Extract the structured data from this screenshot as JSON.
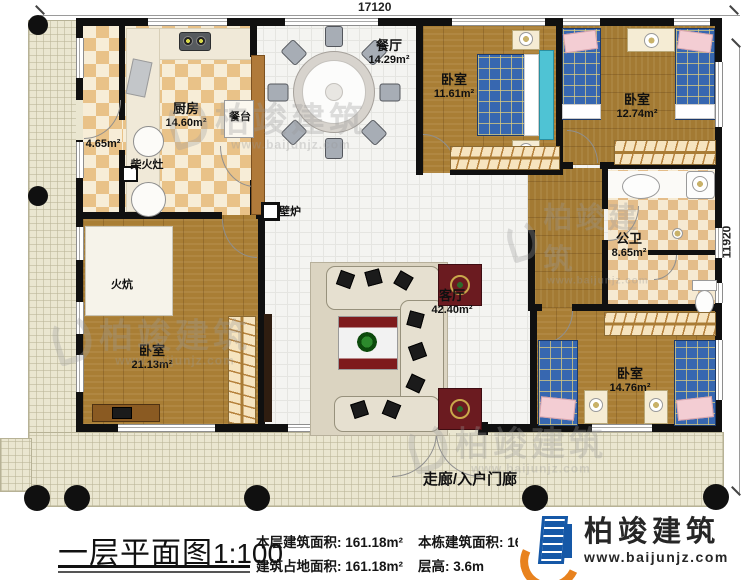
{
  "dimensions": {
    "width_label": "17120",
    "height_label": "11920"
  },
  "title": {
    "text": "一层平面图",
    "scale": "1:100"
  },
  "stats": {
    "floor_area_label": "本层建筑面积:",
    "floor_area_value": "161.18m²",
    "total_area_label": "本栋建筑面积:",
    "total_area_value": "161.1",
    "footprint_label": "建筑占地面积:",
    "footprint_value": "161.18m²",
    "story_height_label": "层高:",
    "story_height_value": "3.6m"
  },
  "brand": {
    "name": "柏竣建筑",
    "website": "www.baijunjz.com"
  },
  "watermark": {
    "name": "柏竣建筑",
    "website": "www.baijunjz.com"
  },
  "rooms": {
    "dining": {
      "name": "餐厅",
      "area": "14.29m²"
    },
    "bedroom_top": {
      "name": "卧室",
      "area": "11.61m²"
    },
    "bedroom_topright": {
      "name": "卧室",
      "area": "12.74m²"
    },
    "kitchen": {
      "name": "厨房",
      "area": "14.60m²"
    },
    "pantry": {
      "area": "4.65m²"
    },
    "living": {
      "name": "客厅",
      "area": "42.40m²"
    },
    "bath": {
      "name": "公卫",
      "area": "8.65m²"
    },
    "bedroom_left": {
      "name": "卧室",
      "area": "21.13m²"
    },
    "bedroom_bottomright": {
      "name": "卧室",
      "area": "14.76m²"
    }
  },
  "features": {
    "dining_counter": "餐台",
    "wood_stove": "柴火灶",
    "fireplace": "壁炉",
    "kang": "火炕",
    "porch": "走廊/入户门廊"
  }
}
